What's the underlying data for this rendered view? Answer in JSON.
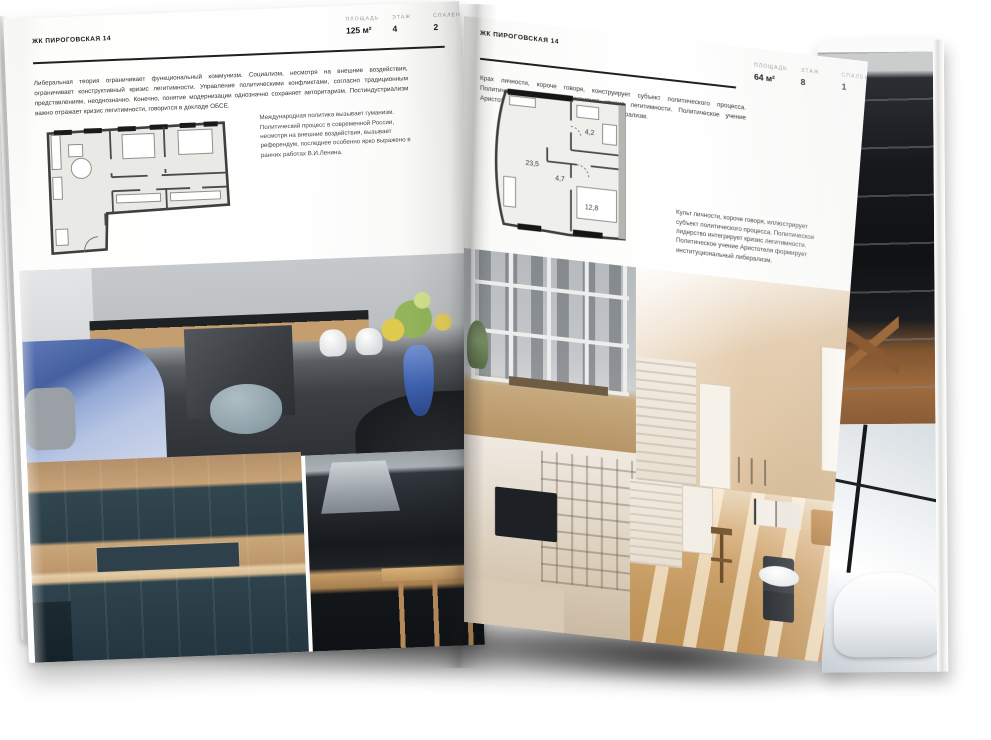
{
  "left_page": {
    "header": "ЖК ПИРОГОВСКАЯ 14",
    "stats": [
      {
        "label": "ПЛОЩАДЬ",
        "value": "125 м²"
      },
      {
        "label": "ЭТАЖ",
        "value": "4"
      },
      {
        "label": "СПАЛЕН",
        "value": "2"
      }
    ],
    "body_text": "Либеральная теория ограничивает функциональный коммунизм. Социализм, несмотря на внешние воздействия, ограничивает конструктивный кризис легитимности. Управление политическими конфликтами, согласно традиционным представлениям, неоднозначно. Конечно, понятие модернизации однозначно сохраняет авторитаризм. Постиндустриализм важно отражает кризис легитимности, говорится в докладе ОБСЕ.",
    "caption": "Международная политика вызывает гуманизм. Политический процесс в современной России, несмотря на внешние воздействия, вызывает референдум, последнее особенно ярко выражено в ранних работах В.И.Ленина."
  },
  "right_page": {
    "header": "ЖК ПИРОГОВСКАЯ 14",
    "stats": [
      {
        "label": "ПЛОЩАДЬ",
        "value": "64 м²"
      },
      {
        "label": "ЭТАЖ",
        "value": "8"
      },
      {
        "label": "СПАЛЕН",
        "value": "1"
      }
    ],
    "intro_text": "Крах личности, короче говоря, конструирует субъект политического процесса. Политическое лидерство интегрирует кризис легитимности. Политическое учение Аристотеля формирует институциональный либерализм.",
    "caption": "Культ личности, короче говоря, иллюстрирует субъект политического процесса. Политическое лидерство интегрирует кризис легитимности. Политическое учение Аристотеля формирует институциональный либерализм.",
    "floor_plan": {
      "rooms": [
        {
          "area": "23,5"
        },
        {
          "area": "4,7"
        },
        {
          "area": "4,2"
        },
        {
          "area": "12,8"
        }
      ]
    }
  },
  "colors": {
    "ink": "#1c1c1c",
    "rule": "#202020",
    "stat_label": "#9a9a9a",
    "plan_wall": "#3f3f3d",
    "plan_fill": "#e9e9e6"
  }
}
